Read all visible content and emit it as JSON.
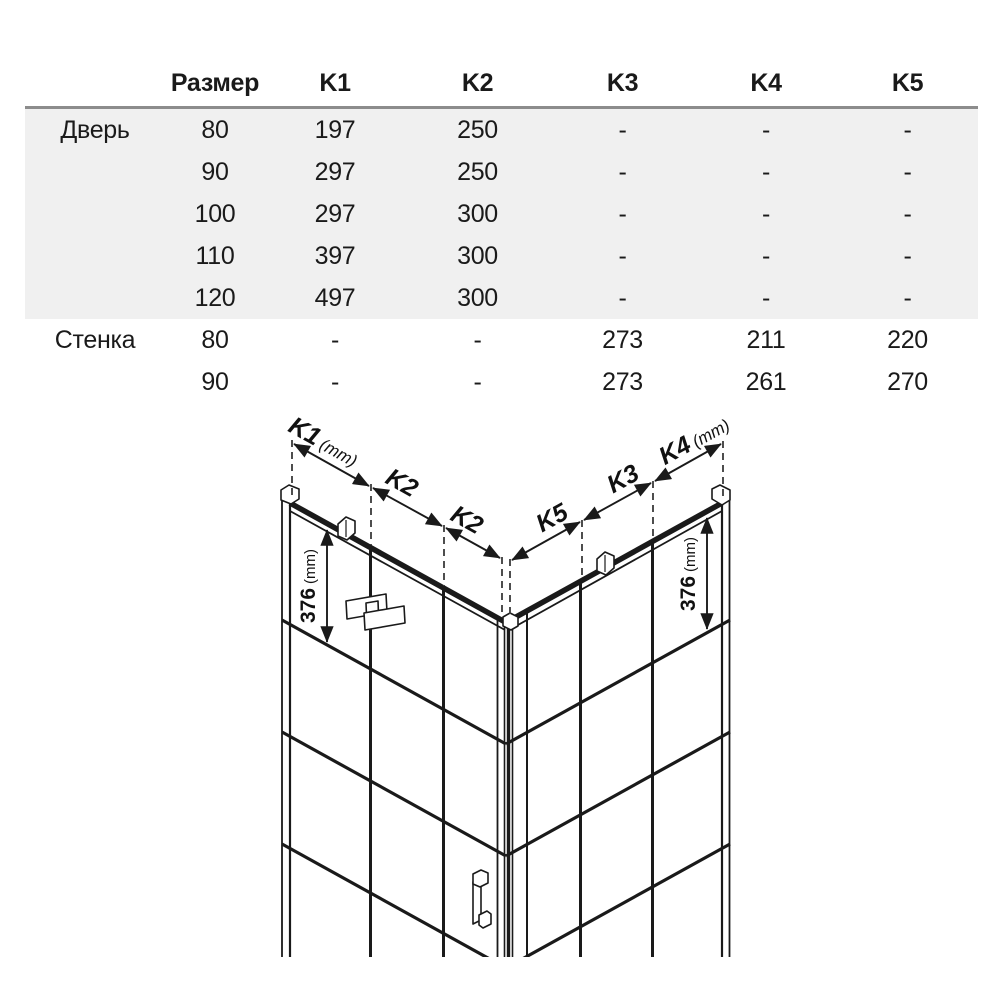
{
  "table": {
    "header": [
      "Размер",
      "K1",
      "K2",
      "K3",
      "K4",
      "K5"
    ],
    "sections": [
      {
        "label": "Дверь",
        "rows": [
          [
            "80",
            "197",
            "250",
            "-",
            "-",
            "-"
          ],
          [
            "90",
            "297",
            "250",
            "-",
            "-",
            "-"
          ],
          [
            "100",
            "297",
            "300",
            "-",
            "-",
            "-"
          ],
          [
            "110",
            "397",
            "300",
            "-",
            "-",
            "-"
          ],
          [
            "120",
            "497",
            "300",
            "-",
            "-",
            "-"
          ]
        ]
      },
      {
        "label": "Стенка",
        "rows": [
          [
            "80",
            "-",
            "-",
            "273",
            "211",
            "220"
          ],
          [
            "90",
            "-",
            "-",
            "273",
            "261",
            "270"
          ]
        ]
      }
    ]
  },
  "diagram": {
    "left_chain": [
      {
        "k": "K1",
        "unit": "(mm)"
      },
      {
        "k": "K2",
        "unit": ""
      },
      {
        "k": "K2",
        "unit": ""
      }
    ],
    "right_chain": [
      {
        "k": "K5",
        "unit": ""
      },
      {
        "k": "K3",
        "unit": ""
      },
      {
        "k": "K4",
        "unit": "(mm)"
      }
    ],
    "height_dim": {
      "value": "376",
      "unit": "(mm)"
    }
  },
  "colors": {
    "line": "#1a1a1a",
    "section_bg": "#f0f0f0",
    "header_rule": "#8c8c8c",
    "text": "#1a1a1a"
  }
}
